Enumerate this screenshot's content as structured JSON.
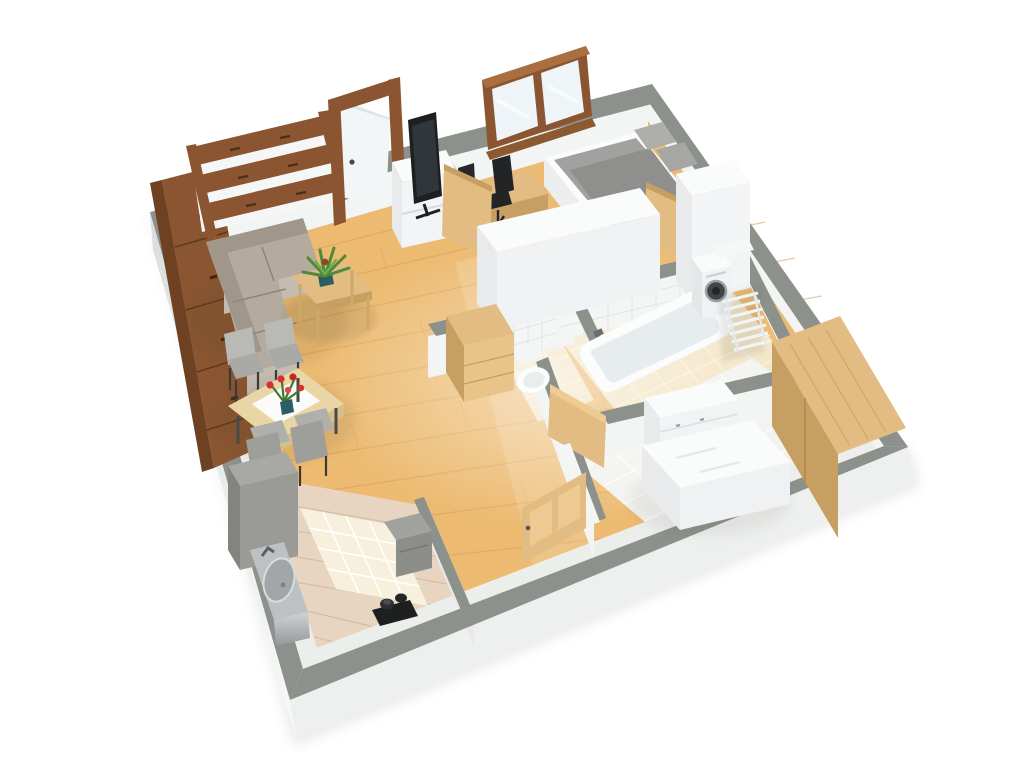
{
  "scene": {
    "type": "3d-apartment-floor-plan-render",
    "background": "#ffffff"
  },
  "colors": {
    "wall_cap": "#8c918c",
    "wall_outer_left": "#e0e3e2",
    "wall_outer_bottom": "#eef0ef",
    "wall_inner": "#f3f5f4",
    "floor_wood": "#ecba70",
    "floor_wood_seam": "#d89f55",
    "floor_kitchen": "#e7d5c2",
    "kitchen_seam": "#d6bda4",
    "tile_beige": "#f3e5c5",
    "tile_white": "#f2f2ef",
    "tile_mat": "#f6f0dc",
    "wall_tile": "#f4f6f6",
    "wood_brown": "#8a5530",
    "wood_brown_dark": "#6e4122",
    "wood_brown_light": "#a96f3f",
    "wood_light": "#e2bc82",
    "wood_light_dark": "#c89f62",
    "white_furniture": "#fafbfb",
    "white_furniture_side": "#e8eaeb",
    "sofa": "#b4ab9e",
    "sofa_dark": "#a0978a",
    "sofa_light": "#c4bcb0",
    "grey_furniture": "#9a9a96",
    "steel": "#bdc1c3",
    "dark": "#1e1f20",
    "bed_grey": "#a1a19f",
    "blanket_grey": "#8f908e",
    "plant_green": "#4f8a3a",
    "flower_red": "#d3302f",
    "vase_teal": "#2b5f63",
    "glass": "#eef4f7"
  },
  "rooms": [
    {
      "name": "living-room",
      "floor": "wood-planks",
      "furniture": [
        "corner-sofa",
        "coffee-table",
        "potted-plant",
        "wall-shelf",
        "tall-brown-cabinet",
        "dining-table",
        "dining-chairs",
        "flower-vase",
        "tv-lowboard",
        "tv",
        "entry-door"
      ]
    },
    {
      "name": "office-bedroom",
      "floor": "wood-planks",
      "furniture": [
        "window",
        "desk",
        "monitor",
        "office-chair",
        "grey-bed",
        "white-wardrobe",
        "white-cabinet",
        "wood-door"
      ]
    },
    {
      "name": "bathroom",
      "floor": "beige-tiles",
      "furniture": [
        "bathtub",
        "washing-machine",
        "towel-radiator",
        "wall-cabinet",
        "wood-door"
      ]
    },
    {
      "name": "wc",
      "floor": "beige-tiles",
      "furniture": [
        "toilet",
        "wood-door",
        "hall-sideboard"
      ]
    },
    {
      "name": "bedroom",
      "floor": "white-tiles",
      "furniture": [
        "double-bed",
        "dresser",
        "wood-wardrobe",
        "wood-door"
      ]
    },
    {
      "name": "kitchen",
      "floor": "whitewashed-planks",
      "furniture": [
        "fridge",
        "steel-sink-unit",
        "stove-counter",
        "black-appliance",
        "white-tile-mat"
      ]
    }
  ]
}
